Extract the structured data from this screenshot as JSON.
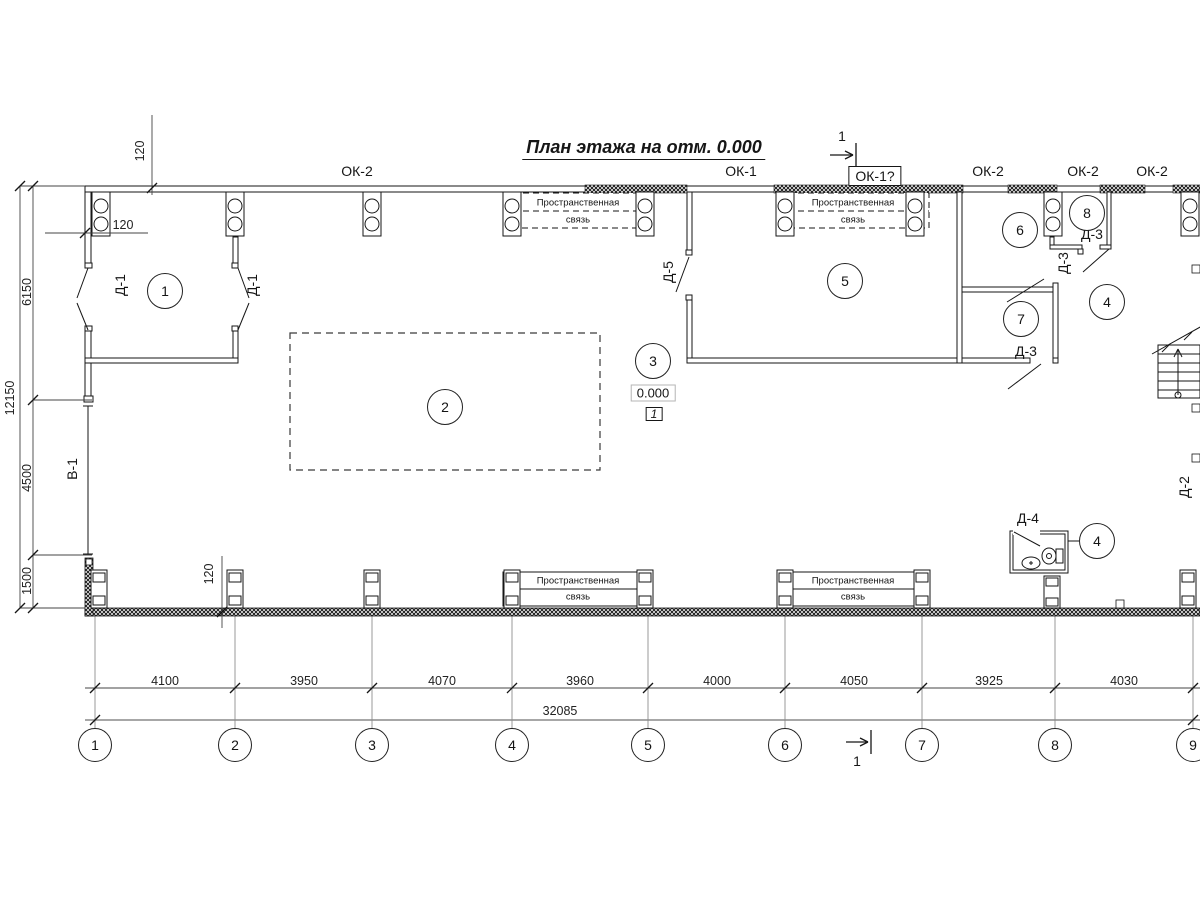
{
  "title": "План этажа на отм. 0.000",
  "section_marks": {
    "top": "1",
    "bottom": "1"
  },
  "window_labels": [
    "ОК-2",
    "ОК-1",
    "ОК-1?",
    "ОК-2",
    "ОК-2",
    "ОК-2"
  ],
  "door_labels": {
    "d1_left": "Д-1",
    "d1_right": "Д-1",
    "d5": "Д-5",
    "d3_room8": "Д-3",
    "d3_mid": "Д-3",
    "d3_room7": "Д-3",
    "d4": "Д-4",
    "d2": "Д-2",
    "v1": "В-1"
  },
  "room_numbers": {
    "r1": "1",
    "r2": "2",
    "r3": "3",
    "r4a": "4",
    "r4b": "4",
    "r5": "5",
    "r6": "6",
    "r7": "7",
    "r8": "8"
  },
  "elevation": {
    "value": "0.000",
    "node": "1"
  },
  "brace": {
    "line1": "Пространственная",
    "line2": "связь"
  },
  "dimensions": {
    "offset_top": "120",
    "offset_left": "120",
    "offset_bottom": "120",
    "left_segments": [
      "6150",
      "4500",
      "1500"
    ],
    "left_total": "12150",
    "bottom_segments": [
      "4100",
      "3950",
      "4070",
      "3960",
      "4000",
      "4050",
      "3925",
      "4030"
    ],
    "bottom_total": "32085"
  },
  "axis_labels": [
    "1",
    "2",
    "3",
    "4",
    "5",
    "6",
    "7",
    "8",
    "9"
  ],
  "colors": {
    "line": "#161616",
    "dim": "#333333",
    "guide": "#999999"
  }
}
